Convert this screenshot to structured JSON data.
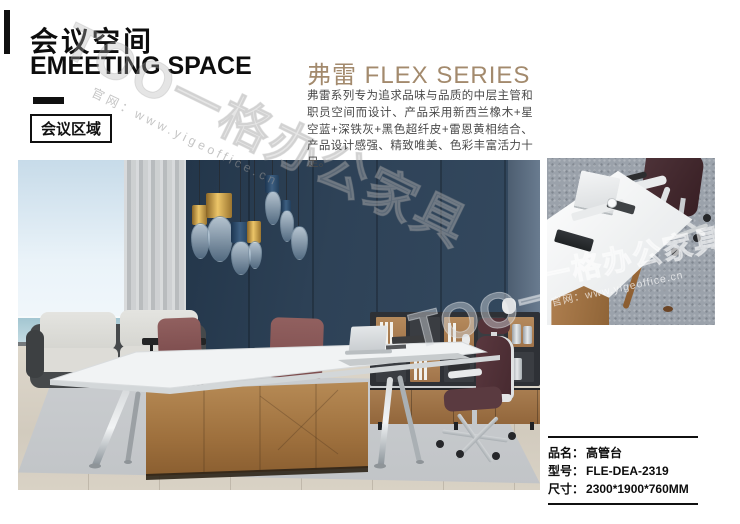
{
  "header": {
    "title_cn": "会议空间",
    "title_en": "EMEETING SPACE",
    "zone_badge": "会议区域"
  },
  "series": {
    "title": "弗雷 FLEX SERIES",
    "description": "弗雷系列专为追求品味与品质的中层主管和职员空间而设计、产品采用新西兰橡木+星空蓝+深铁灰+黑色超纤皮+雷恩黄相结合、产品设计感强、精致唯美、色彩丰富活力十足。",
    "accent_color": "#a38a6d"
  },
  "product_info": {
    "rows": [
      {
        "label": "品名：",
        "value": "高管台"
      },
      {
        "label": "型号：",
        "value": "FLE-DEA-2319"
      },
      {
        "label": "尺寸：",
        "value": "2300*1900*760MM"
      }
    ]
  },
  "watermark": {
    "brand_full": "TOO一格办公家具",
    "brand_cn": "一格办公家具",
    "site_label": "官网：www.yigeoffice.cn"
  },
  "colors": {
    "accent": "#a38a6d",
    "wall_navy": "#2e4257",
    "bronze": "#aa7a48"
  }
}
